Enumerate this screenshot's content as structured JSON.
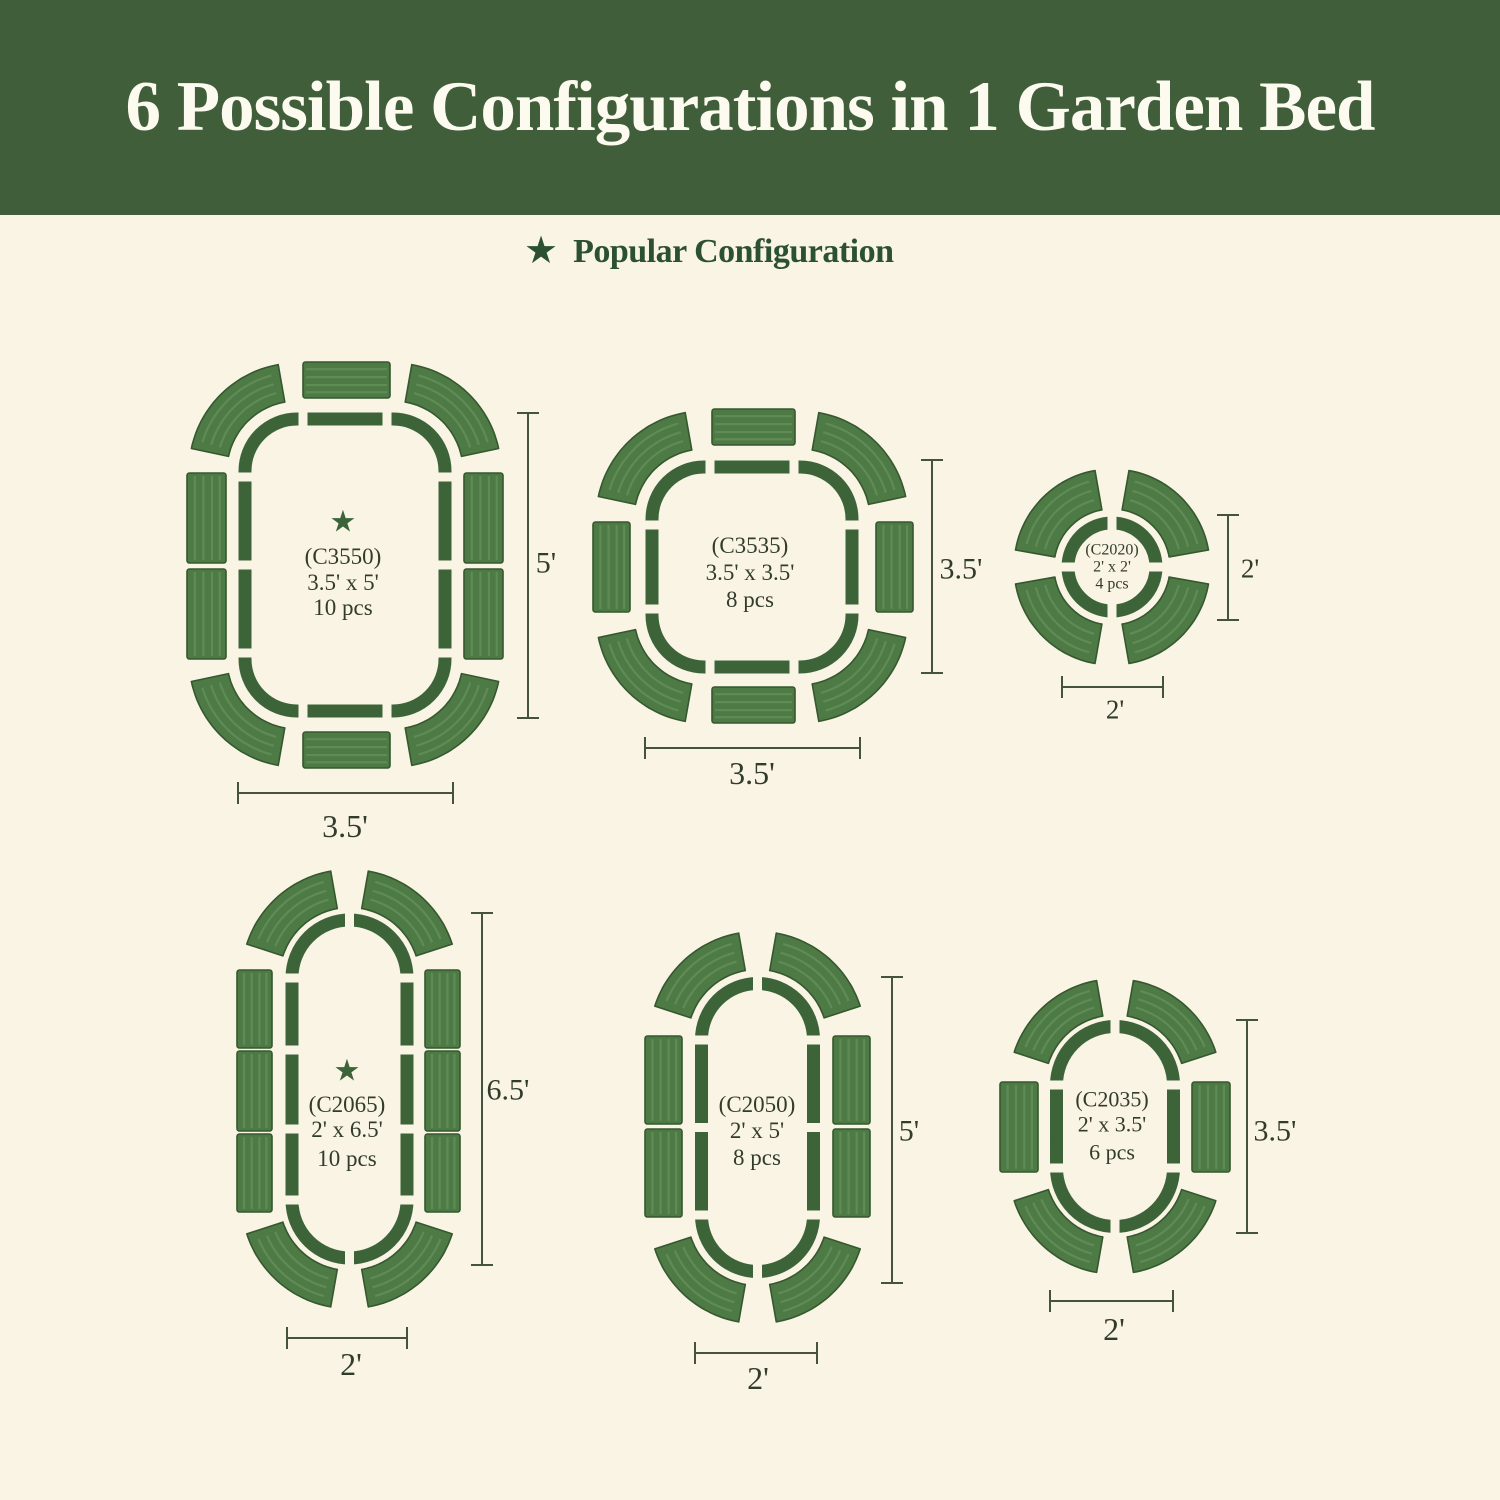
{
  "header": {
    "title": "6 Possible Configurations in 1 Garden Bed"
  },
  "legend": {
    "label": "Popular Configuration"
  },
  "icons": {
    "star": "★"
  },
  "colors": {
    "page_bg": "#faf4e4",
    "banner_bg": "#3f5e39",
    "banner_text": "#fdfaef",
    "legend_text": "#2b5132",
    "outline_green": "#3d6439",
    "panel_green": "#4e7a46",
    "panel_ridge": "#5f8c55",
    "panel_edge": "#35582e",
    "dim_line": "#45533e",
    "label_text": "#323c2b"
  },
  "configs": [
    {
      "code": "(C3550)",
      "size": "3.5' x 5'",
      "pcs": "10 pcs",
      "starred": true,
      "dim_right": "5'",
      "dim_bottom": "3.5'",
      "layout": {
        "left": 165,
        "top": 345,
        "w": 410,
        "h": 510,
        "bed": {
          "type": "roundrect",
          "x": 80,
          "y": 74,
          "w": 200,
          "h": 292,
          "r": 52,
          "gaps": [
            [
              138,
              74,
              "v"
            ],
            [
              222,
              74,
              "v"
            ],
            [
              138,
              366,
              "v"
            ],
            [
              222,
              366,
              "v"
            ],
            [
              80,
              132,
              "h"
            ],
            [
              80,
              220,
              "h"
            ],
            [
              80,
              308,
              "h"
            ],
            [
              280,
              132,
              "h"
            ],
            [
              280,
              220,
              "h"
            ],
            [
              280,
              308,
              "h"
            ]
          ]
        },
        "panels": [
          [
            138,
            17,
            87,
            36,
            "h"
          ],
          [
            138,
            387,
            87,
            36,
            "h"
          ],
          [
            22,
            128,
            39,
            90,
            "v"
          ],
          [
            22,
            224,
            39,
            90,
            "v"
          ],
          [
            299,
            128,
            39,
            90,
            "v"
          ],
          [
            299,
            224,
            39,
            90,
            "v"
          ]
        ],
        "arc_ri": 70,
        "arc_ro": 108,
        "arc_panels": [
          [
            132,
            126,
            100,
            168
          ],
          [
            228,
            126,
            12,
            80
          ],
          [
            132,
            314,
            192,
            260
          ],
          [
            228,
            314,
            280,
            348
          ]
        ],
        "vdim": {
          "x": 363,
          "y1": 68,
          "y2": 373,
          "lx": 381,
          "ly": 217,
          "fs": 30
        },
        "hdim": {
          "y": 448,
          "x1": 73,
          "x2": 288,
          "lx": 180,
          "ly": 481,
          "fs": 32
        },
        "star": [
          178,
          176
        ],
        "cx": 178,
        "label_ys": [
          211,
          237,
          262
        ],
        "label_fs": 23
      }
    },
    {
      "code": "(C3535)",
      "size": "3.5' x 3.5'",
      "pcs": "8 pcs",
      "starred": false,
      "dim_right": "3.5'",
      "dim_bottom": "3.5'",
      "layout": {
        "left": 575,
        "top": 395,
        "w": 420,
        "h": 420,
        "bed": {
          "type": "roundrect",
          "x": 77,
          "y": 72,
          "w": 200,
          "h": 200,
          "r": 52,
          "gaps": [
            [
              135,
              72,
              "v"
            ],
            [
              219,
              72,
              "v"
            ],
            [
              135,
              272,
              "v"
            ],
            [
              219,
              272,
              "v"
            ],
            [
              77,
              130,
              "h"
            ],
            [
              77,
              214,
              "h"
            ],
            [
              277,
              130,
              "h"
            ],
            [
              277,
              214,
              "h"
            ]
          ]
        },
        "panels": [
          [
            137,
            14,
            83,
            36,
            "h"
          ],
          [
            137,
            292,
            83,
            36,
            "h"
          ],
          [
            18,
            127,
            37,
            90,
            "v"
          ],
          [
            301,
            127,
            37,
            90,
            "v"
          ]
        ],
        "arc_ri": 70,
        "arc_ro": 108,
        "arc_panels": [
          [
            129,
            124,
            100,
            168
          ],
          [
            225,
            124,
            12,
            80
          ],
          [
            129,
            220,
            192,
            260
          ],
          [
            225,
            220,
            280,
            348
          ]
        ],
        "vdim": {
          "x": 357,
          "y1": 65,
          "y2": 278,
          "lx": 386,
          "ly": 173,
          "fs": 30
        },
        "hdim": {
          "y": 353,
          "x1": 70,
          "x2": 285,
          "lx": 177,
          "ly": 378,
          "fs": 32
        },
        "cx": 175,
        "label_ys": [
          150,
          177,
          204
        ],
        "label_fs": 23
      }
    },
    {
      "code": "(C2020)",
      "size": "2' x 2'",
      "pcs": "4 pcs",
      "starred": false,
      "dim_right": "2'",
      "dim_bottom": "2'",
      "layout": {
        "left": 995,
        "top": 455,
        "w": 300,
        "h": 300,
        "bed": {
          "type": "circle",
          "cx": 117,
          "cy": 112,
          "r": 44,
          "gaps": [
            [
              117,
              68,
              "v"
            ],
            [
              117,
              156,
              "v"
            ],
            [
              73,
              112,
              "h"
            ],
            [
              161,
              112,
              "h"
            ]
          ]
        },
        "panels": [],
        "arc_ri": 58,
        "arc_ro": 98,
        "arc_panels": [
          [
            117,
            112,
            100,
            170
          ],
          [
            117,
            112,
            10,
            80
          ],
          [
            117,
            112,
            190,
            260
          ],
          [
            117,
            112,
            280,
            350
          ]
        ],
        "vdim": {
          "x": 233,
          "y1": 60,
          "y2": 165,
          "lx": 255,
          "ly": 113,
          "fs": 27
        },
        "hdim": {
          "y": 232,
          "x1": 67,
          "x2": 168,
          "lx": 120,
          "ly": 254,
          "fs": 27
        },
        "cx": 117,
        "label_ys": [
          94,
          111,
          128
        ],
        "label_fs": 16
      }
    },
    {
      "code": "(C2065)",
      "size": "2' x 6.5'",
      "pcs": "10 pcs",
      "starred": true,
      "dim_right": "6.5'",
      "dim_bottom": "2'",
      "layout": {
        "left": 175,
        "top": 855,
        "w": 390,
        "h": 580,
        "bed": {
          "type": "roundrect",
          "x": 117,
          "y": 65,
          "w": 115,
          "h": 338,
          "r": 57.5,
          "gaps": [
            [
              174.5,
              65,
              "v"
            ],
            [
              174.5,
              403,
              "v"
            ],
            [
              117,
              123,
              "h"
            ],
            [
              232,
              123,
              "h"
            ],
            [
              117,
              345,
              "h"
            ],
            [
              232,
              345,
              "h"
            ],
            [
              117,
              195,
              "h"
            ],
            [
              232,
              195,
              "h"
            ],
            [
              117,
              274,
              "h"
            ],
            [
              232,
              274,
              "h"
            ]
          ]
        },
        "panels": [
          [
            62,
            115,
            35,
            78,
            "v"
          ],
          [
            62,
            196,
            35,
            80,
            "v"
          ],
          [
            62,
            279,
            35,
            78,
            "v"
          ],
          [
            250,
            115,
            35,
            78,
            "v"
          ],
          [
            250,
            196,
            35,
            80,
            "v"
          ],
          [
            250,
            279,
            35,
            78,
            "v"
          ]
        ],
        "arc_ri": 70,
        "arc_ro": 108,
        "arc_panels": [
          [
            174.5,
            122.5,
            100,
            162
          ],
          [
            174.5,
            122.5,
            18,
            80
          ],
          [
            174.5,
            345.5,
            198,
            260
          ],
          [
            174.5,
            345.5,
            280,
            342
          ]
        ],
        "vdim": {
          "x": 307,
          "y1": 58,
          "y2": 410,
          "lx": 333,
          "ly": 234,
          "fs": 30
        },
        "hdim": {
          "y": 483,
          "x1": 112,
          "x2": 232,
          "lx": 176,
          "ly": 509,
          "fs": 32
        },
        "star": [
          172,
          215
        ],
        "cx": 172,
        "label_ys": [
          249,
          274,
          303
        ],
        "label_fs": 23
      }
    },
    {
      "code": "(C2050)",
      "size": "2' x 5'",
      "pcs": "8 pcs",
      "starred": false,
      "dim_right": "5'",
      "dim_bottom": "2'",
      "layout": {
        "left": 615,
        "top": 920,
        "w": 340,
        "h": 480,
        "bed": {
          "type": "roundrect",
          "x": 86.5,
          "y": 63.5,
          "w": 112,
          "h": 288,
          "r": 56,
          "gaps": [
            [
              142.5,
              63.5,
              "v"
            ],
            [
              142.5,
              351.5,
              "v"
            ],
            [
              86.5,
              120,
              "h"
            ],
            [
              198.5,
              120,
              "h"
            ],
            [
              86.5,
              295,
              "h"
            ],
            [
              198.5,
              295,
              "h"
            ],
            [
              86.5,
              207.5,
              "h"
            ],
            [
              198.5,
              207.5,
              "h"
            ]
          ]
        },
        "panels": [
          [
            30,
            116,
            37,
            88,
            "v"
          ],
          [
            30,
            209,
            37,
            88,
            "v"
          ],
          [
            218,
            116,
            37,
            88,
            "v"
          ],
          [
            218,
            209,
            37,
            88,
            "v"
          ]
        ],
        "arc_ri": 70,
        "arc_ro": 108,
        "arc_panels": [
          [
            142.5,
            119.5,
            100,
            162
          ],
          [
            142.5,
            119.5,
            18,
            80
          ],
          [
            142.5,
            295.5,
            198,
            260
          ],
          [
            142.5,
            295.5,
            280,
            342
          ]
        ],
        "vdim": {
          "x": 277,
          "y1": 57,
          "y2": 363,
          "lx": 294,
          "ly": 210,
          "fs": 30
        },
        "hdim": {
          "y": 433,
          "x1": 80,
          "x2": 202,
          "lx": 143,
          "ly": 458,
          "fs": 32
        },
        "cx": 142,
        "label_ys": [
          184,
          210,
          237
        ],
        "label_fs": 23
      }
    },
    {
      "code": "(C2035)",
      "size": "2' x 3.5'",
      "pcs": "6 pcs",
      "starred": false,
      "dim_right": "3.5'",
      "dim_bottom": "2'",
      "layout": {
        "left": 975,
        "top": 965,
        "w": 340,
        "h": 420,
        "bed": {
          "type": "roundrect",
          "x": 81.5,
          "y": 61.5,
          "w": 117,
          "h": 200,
          "r": 58.5,
          "gaps": [
            [
              140,
              61.5,
              "v"
            ],
            [
              140,
              261.5,
              "v"
            ],
            [
              81.5,
              120,
              "h"
            ],
            [
              198.5,
              120,
              "h"
            ],
            [
              81.5,
              203,
              "h"
            ],
            [
              198.5,
              203,
              "h"
            ]
          ]
        },
        "panels": [
          [
            25,
            117,
            38,
            90,
            "v"
          ],
          [
            217,
            117,
            38,
            90,
            "v"
          ]
        ],
        "arc_ri": 70,
        "arc_ro": 106,
        "arc_panels": [
          [
            140,
            120,
            100,
            162
          ],
          [
            140,
            120,
            18,
            80
          ],
          [
            140,
            203,
            198,
            260
          ],
          [
            140,
            203,
            280,
            342
          ]
        ],
        "vdim": {
          "x": 272,
          "y1": 55,
          "y2": 268,
          "lx": 300,
          "ly": 165,
          "fs": 30
        },
        "hdim": {
          "y": 336,
          "x1": 75,
          "x2": 198,
          "lx": 139,
          "ly": 364,
          "fs": 32
        },
        "cx": 137,
        "label_ys": [
          134,
          159,
          187
        ],
        "label_fs": 22
      }
    }
  ]
}
